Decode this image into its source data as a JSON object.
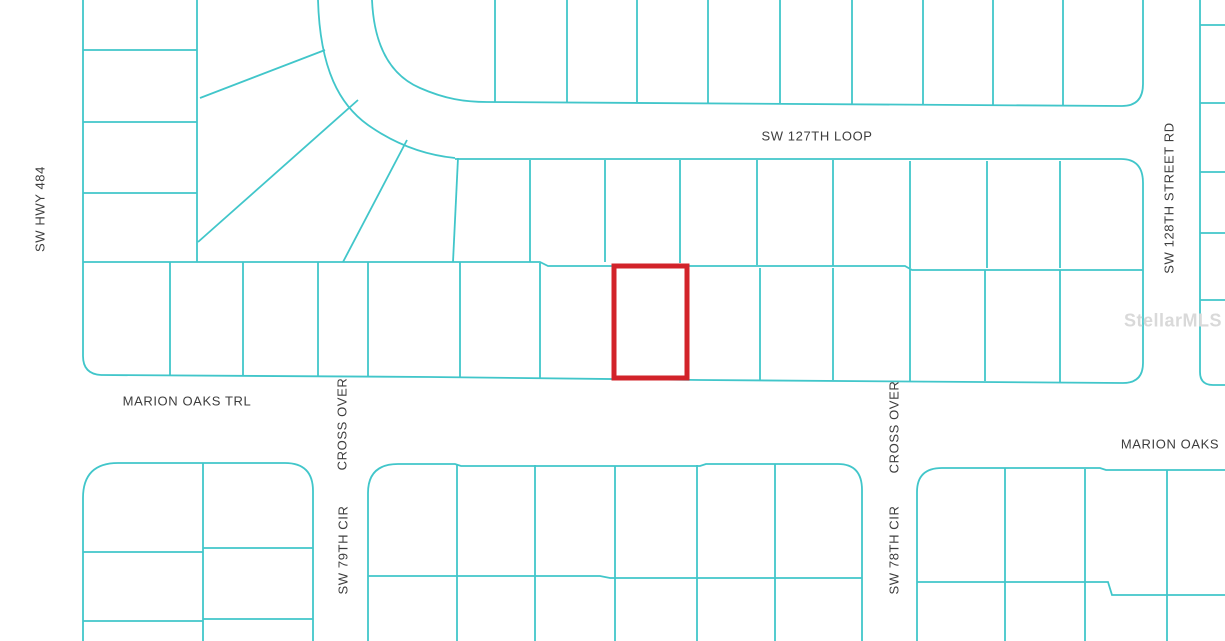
{
  "map": {
    "type": "plat-map",
    "street_labels": {
      "sw_hwy_484": "SW HWY 484",
      "sw_127th_loop": "SW 127TH LOOP",
      "sw_128th_street_rd": "SW 128TH STREET RD",
      "marion_oaks_trl": "MARION OAKS TRL",
      "cross_over_left": "CROSS OVER",
      "cross_over_right": "CROSS OVER",
      "sw_79th_cir": "SW 79TH CIR",
      "sw_78th_cir": "SW 78TH CIR",
      "marion_oaks_right": "MARION OAKS"
    },
    "watermark": "StellarMLS"
  },
  "colors": {
    "background": "#ffffff",
    "line": "#41c6ca",
    "highlight": "#d2232a",
    "label": "#3d3d3d",
    "watermark": "#d9d9d9"
  }
}
